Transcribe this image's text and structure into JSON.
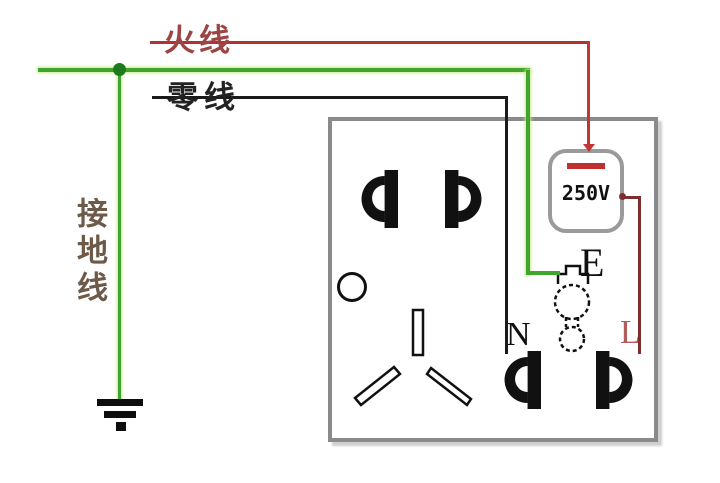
{
  "labels": {
    "live_wire": "火线",
    "neutral_wire": "零线",
    "ground_wire": "接地线",
    "voltage": "250V",
    "terminal_e": "E",
    "terminal_n": "N",
    "terminal_l": "L"
  },
  "colors": {
    "live_wire": "#b23232",
    "live_wire_v": "#c23535",
    "live_label": "#9c4545",
    "neutral_wire": "#1a1a1a",
    "green_wire": "#3fa52e",
    "green_halo": "#cbe68a",
    "junction": "#1d7a1d",
    "ground_label": "#6d5a49",
    "l_wire": "#7d2f2f",
    "l_label": "#b25c5c",
    "box_border": "#8a8a8a",
    "voltage_border": "#9a9a9a",
    "voltage_dash": "#c03030"
  }
}
